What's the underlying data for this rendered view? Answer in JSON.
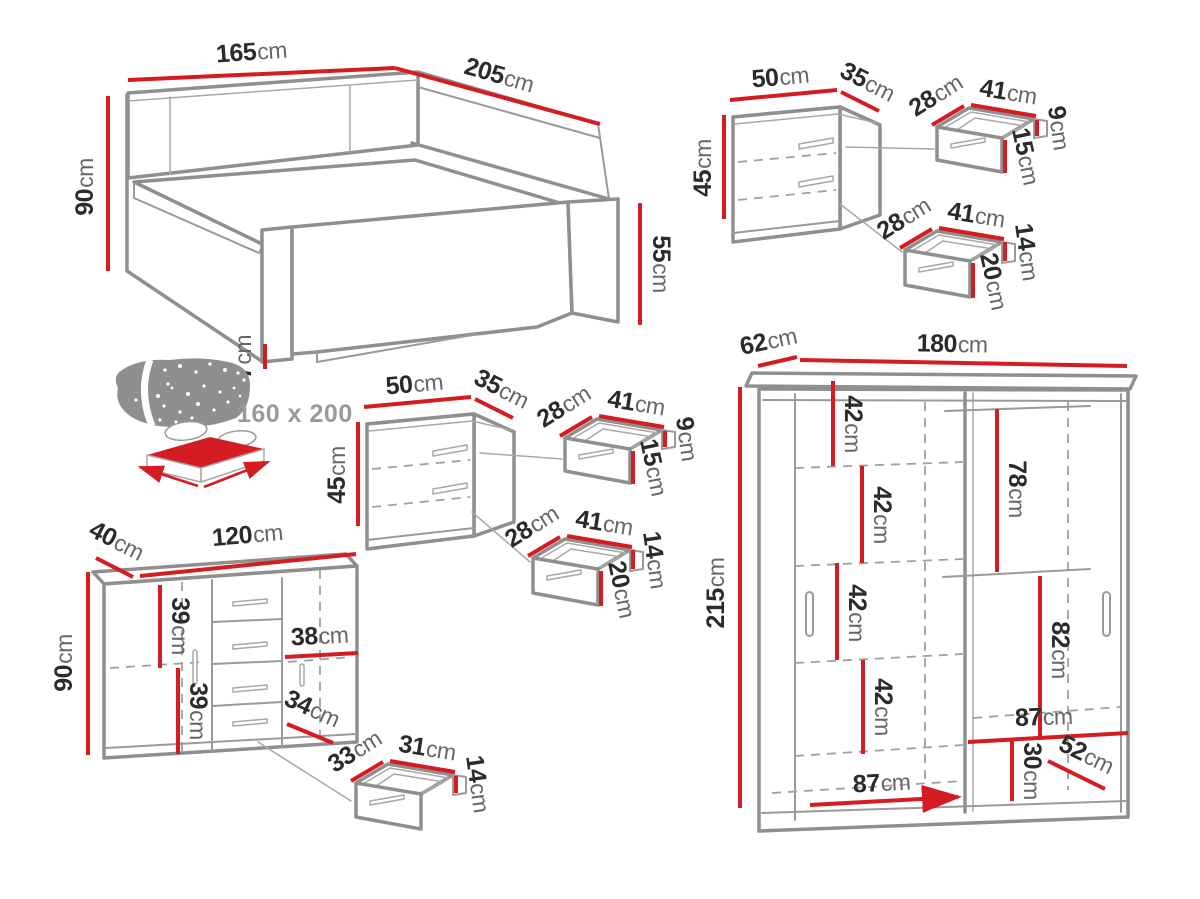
{
  "palette": {
    "dimension_red": "#d31d23",
    "furniture_line": "#8f8f8f",
    "dashed_line": "#a0a0a0",
    "label_number": "#2b2b2b",
    "label_unit": "#666666",
    "muted_text": "#9a9a9a",
    "background": "#ffffff"
  },
  "bed": {
    "width": {
      "v": "165",
      "u": "cm"
    },
    "length": {
      "v": "205",
      "u": "cm"
    },
    "height": {
      "v": "90",
      "u": "cm"
    },
    "footboard_height": {
      "v": "55",
      "u": "cm"
    },
    "plinth_height": {
      "v": "7",
      "u": "cm"
    },
    "mattress_size": "160 x 200"
  },
  "nightstand": {
    "width": {
      "v": "50",
      "u": "cm"
    },
    "depth": {
      "v": "35",
      "u": "cm"
    },
    "height": {
      "v": "45",
      "u": "cm"
    },
    "drawer_top": {
      "depth": {
        "v": "28",
        "u": "cm"
      },
      "width": {
        "v": "41",
        "u": "cm"
      },
      "side_height": {
        "v": "9",
        "u": "cm"
      },
      "front_height": {
        "v": "15",
        "u": "cm"
      }
    },
    "drawer_bottom": {
      "depth": {
        "v": "28",
        "u": "cm"
      },
      "width": {
        "v": "41",
        "u": "cm"
      },
      "side_height": {
        "v": "14",
        "u": "cm"
      },
      "front_height": {
        "v": "20",
        "u": "cm"
      }
    }
  },
  "chest": {
    "depth": {
      "v": "40",
      "u": "cm"
    },
    "width": {
      "v": "120",
      "u": "cm"
    },
    "height": {
      "v": "90",
      "u": "cm"
    },
    "inner_upper": {
      "v": "39",
      "u": "cm"
    },
    "inner_lower": {
      "v": "39",
      "u": "cm"
    },
    "shelf_width": {
      "v": "38",
      "u": "cm"
    },
    "drawer_diagonal": {
      "v": "34",
      "u": "cm"
    },
    "drawer": {
      "depth": {
        "v": "33",
        "u": "cm"
      },
      "width": {
        "v": "31",
        "u": "cm"
      },
      "height": {
        "v": "14",
        "u": "cm"
      }
    }
  },
  "wardrobe": {
    "depth": {
      "v": "62",
      "u": "cm"
    },
    "width": {
      "v": "180",
      "u": "cm"
    },
    "height": {
      "v": "215",
      "u": "cm"
    },
    "shelf_1": {
      "v": "42",
      "u": "cm"
    },
    "shelf_2": {
      "v": "42",
      "u": "cm"
    },
    "shelf_3": {
      "v": "42",
      "u": "cm"
    },
    "shelf_4": {
      "v": "42",
      "u": "cm"
    },
    "hanging_upper": {
      "v": "78",
      "u": "cm"
    },
    "hanging_lower": {
      "v": "82",
      "u": "cm"
    },
    "right_width": {
      "v": "87",
      "u": "cm"
    },
    "bottom_height": {
      "v": "30",
      "u": "cm"
    },
    "bottom_diagonal": {
      "v": "52",
      "u": "cm"
    },
    "left_width": {
      "v": "87",
      "u": "cm"
    }
  }
}
